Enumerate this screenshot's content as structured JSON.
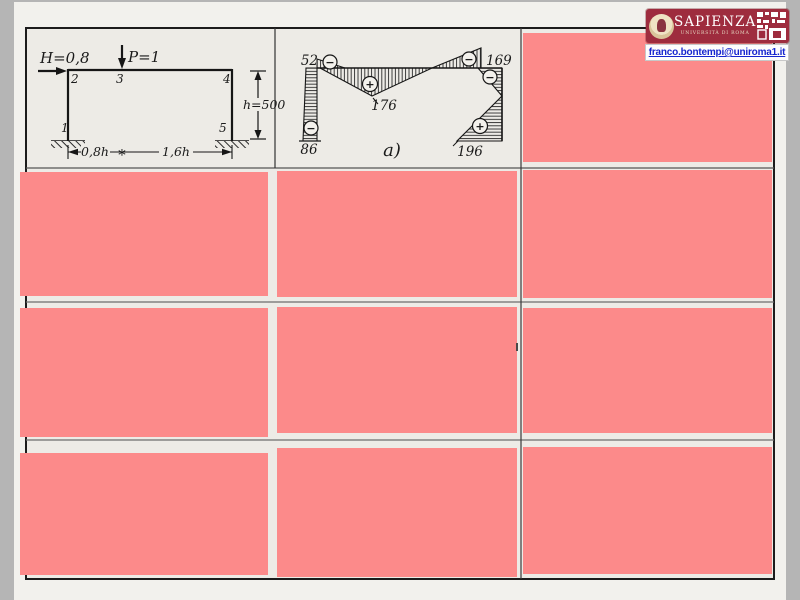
{
  "page": {
    "margin_color": "#b5b5b5",
    "slide_bg": "#f2f1ed",
    "paper_bg": "#edebe6",
    "mask_color": "#fc8a8a"
  },
  "branding": {
    "institution": "SAPIENZA",
    "subtitle": "UNIVERSITÀ DI ROMA",
    "email": "franco.bontempi@uniroma1.it",
    "brand_color": "#9e2c3e"
  },
  "frame_diagram": {
    "horizontal_load_label": "H=0,8",
    "vertical_load_label": "P=1",
    "node_1": "1",
    "node_2": "2",
    "node_3": "3",
    "node_4": "4",
    "node_5": "5",
    "height_dim_label": "h=500",
    "left_span_label": "0,8h",
    "span_separator": "∗",
    "right_span_label": "1,6h"
  },
  "moment_diagram": {
    "caption": "a)",
    "minus_sign": "−",
    "plus_sign": "+",
    "value_col_left_top": "52",
    "value_col_left_bottom": "86",
    "value_beam_max": "176",
    "value_beam_right": "169",
    "value_col_right_bottom": "196"
  }
}
